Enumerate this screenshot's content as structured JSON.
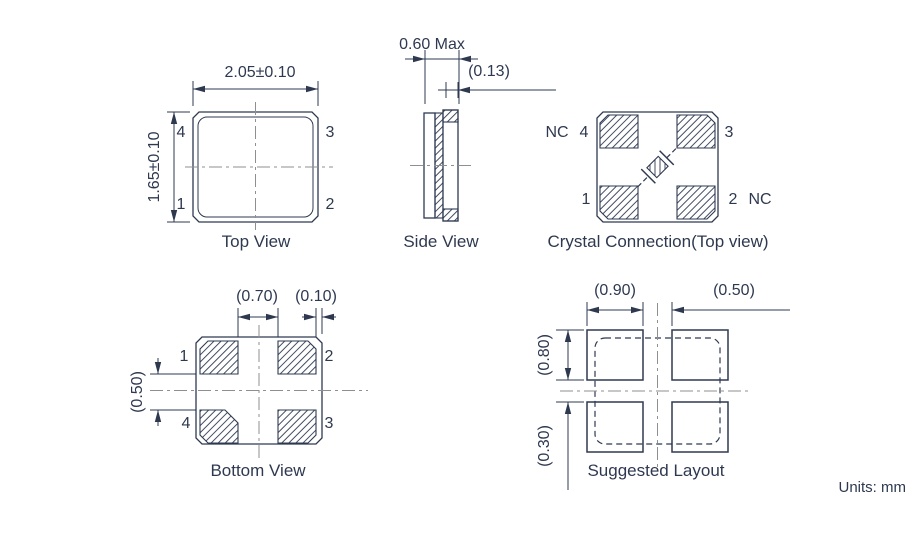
{
  "units_note": "Units: mm",
  "colors": {
    "ink": "#2e3950",
    "centerline": "#8f8f8f",
    "background": "#ffffff"
  },
  "top_view": {
    "label": "Top View",
    "dim_width": "2.05±0.10",
    "dim_height": "1.65±0.10",
    "pin_top_left": "4",
    "pin_top_right": "3",
    "pin_bottom_left": "1",
    "pin_bottom_right": "2"
  },
  "side_view": {
    "label": "Side View",
    "dim_thickness": "0.60 Max",
    "dim_terminal": "(0.13)"
  },
  "crystal_connection": {
    "label": "Crystal Connection(Top view)",
    "pin_top_left": "4",
    "pin_top_left_note": "NC",
    "pin_top_right": "3",
    "pin_bottom_left": "1",
    "pin_bottom_right": "2",
    "pin_bottom_right_note": "NC"
  },
  "bottom_view": {
    "label": "Bottom View",
    "dim_pad_gap_h": "(0.70)",
    "dim_edge_margin": "(0.10)",
    "dim_pad_gap_v": "(0.50)",
    "pin_top_left": "1",
    "pin_top_right": "2",
    "pin_bottom_left": "4",
    "pin_bottom_right": "3"
  },
  "suggested_layout": {
    "label": "Suggested Layout",
    "dim_pad_width": "(0.90)",
    "dim_pad_gap_h": "(0.50)",
    "dim_pad_height": "(0.80)",
    "dim_pad_gap_v": "(0.30)"
  }
}
